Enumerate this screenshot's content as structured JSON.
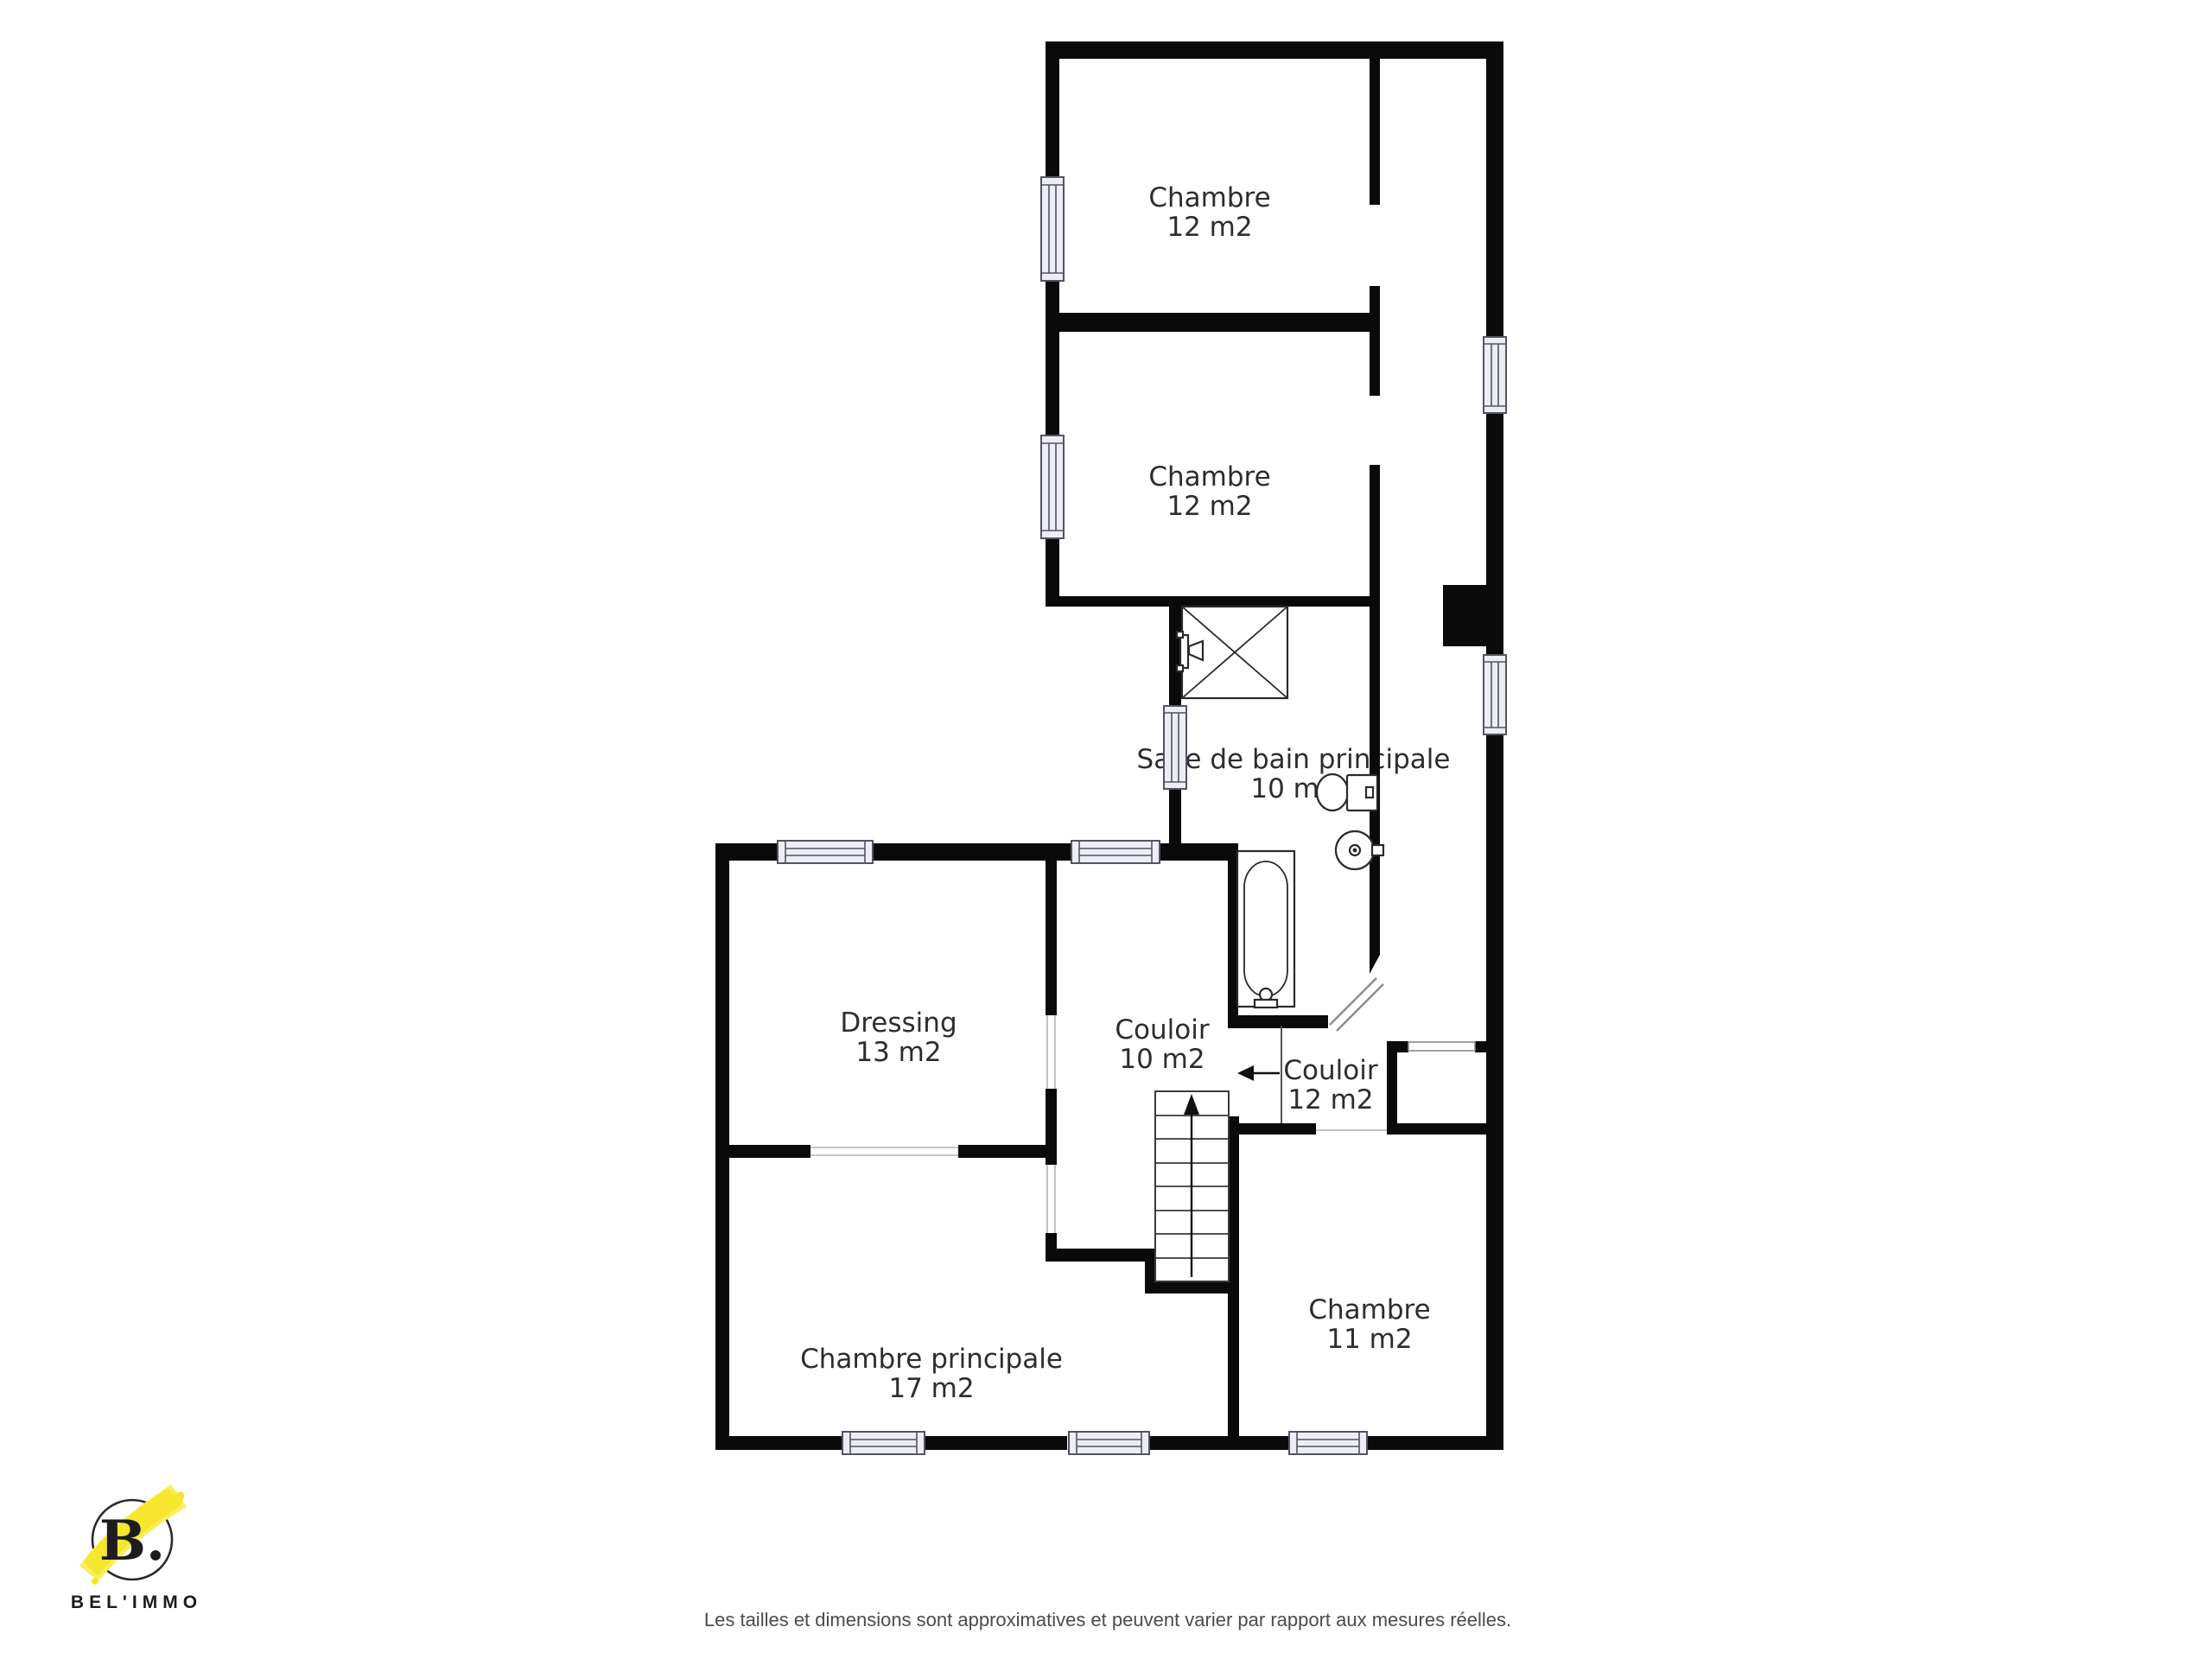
{
  "colors": {
    "background": "#ffffff",
    "wall": "#0a0a0a",
    "window_fill": "#ecedf7",
    "window_stroke": "#54545e",
    "fixture_stroke": "#2a2a2a",
    "room_text": "#2d2d30",
    "disclaimer_text": "#4b4b50",
    "accent_yellow": "#f5e62e"
  },
  "rooms": [
    {
      "name": "Chambre",
      "area": "12 m2"
    },
    {
      "name": "Chambre",
      "area": "12 m2"
    },
    {
      "name": "Salle de bain principale",
      "area": "10 m2"
    },
    {
      "name": "Dressing",
      "area": "13 m2"
    },
    {
      "name": "Couloir",
      "area": "10 m2"
    },
    {
      "name": "Couloir",
      "area": "12 m2"
    },
    {
      "name": "Chambre principale",
      "area": "17 m2"
    },
    {
      "name": "Chambre",
      "area": "11 m2"
    }
  ],
  "fixtures": [
    "shower",
    "bathtub",
    "toilet",
    "sink",
    "staircase"
  ],
  "logo": {
    "initial": "B.",
    "name": "BEL'IMMO"
  },
  "footer": {
    "disclaimer": "Les tailles et dimensions sont approximatives et peuvent varier par rapport aux mesures réelles."
  }
}
